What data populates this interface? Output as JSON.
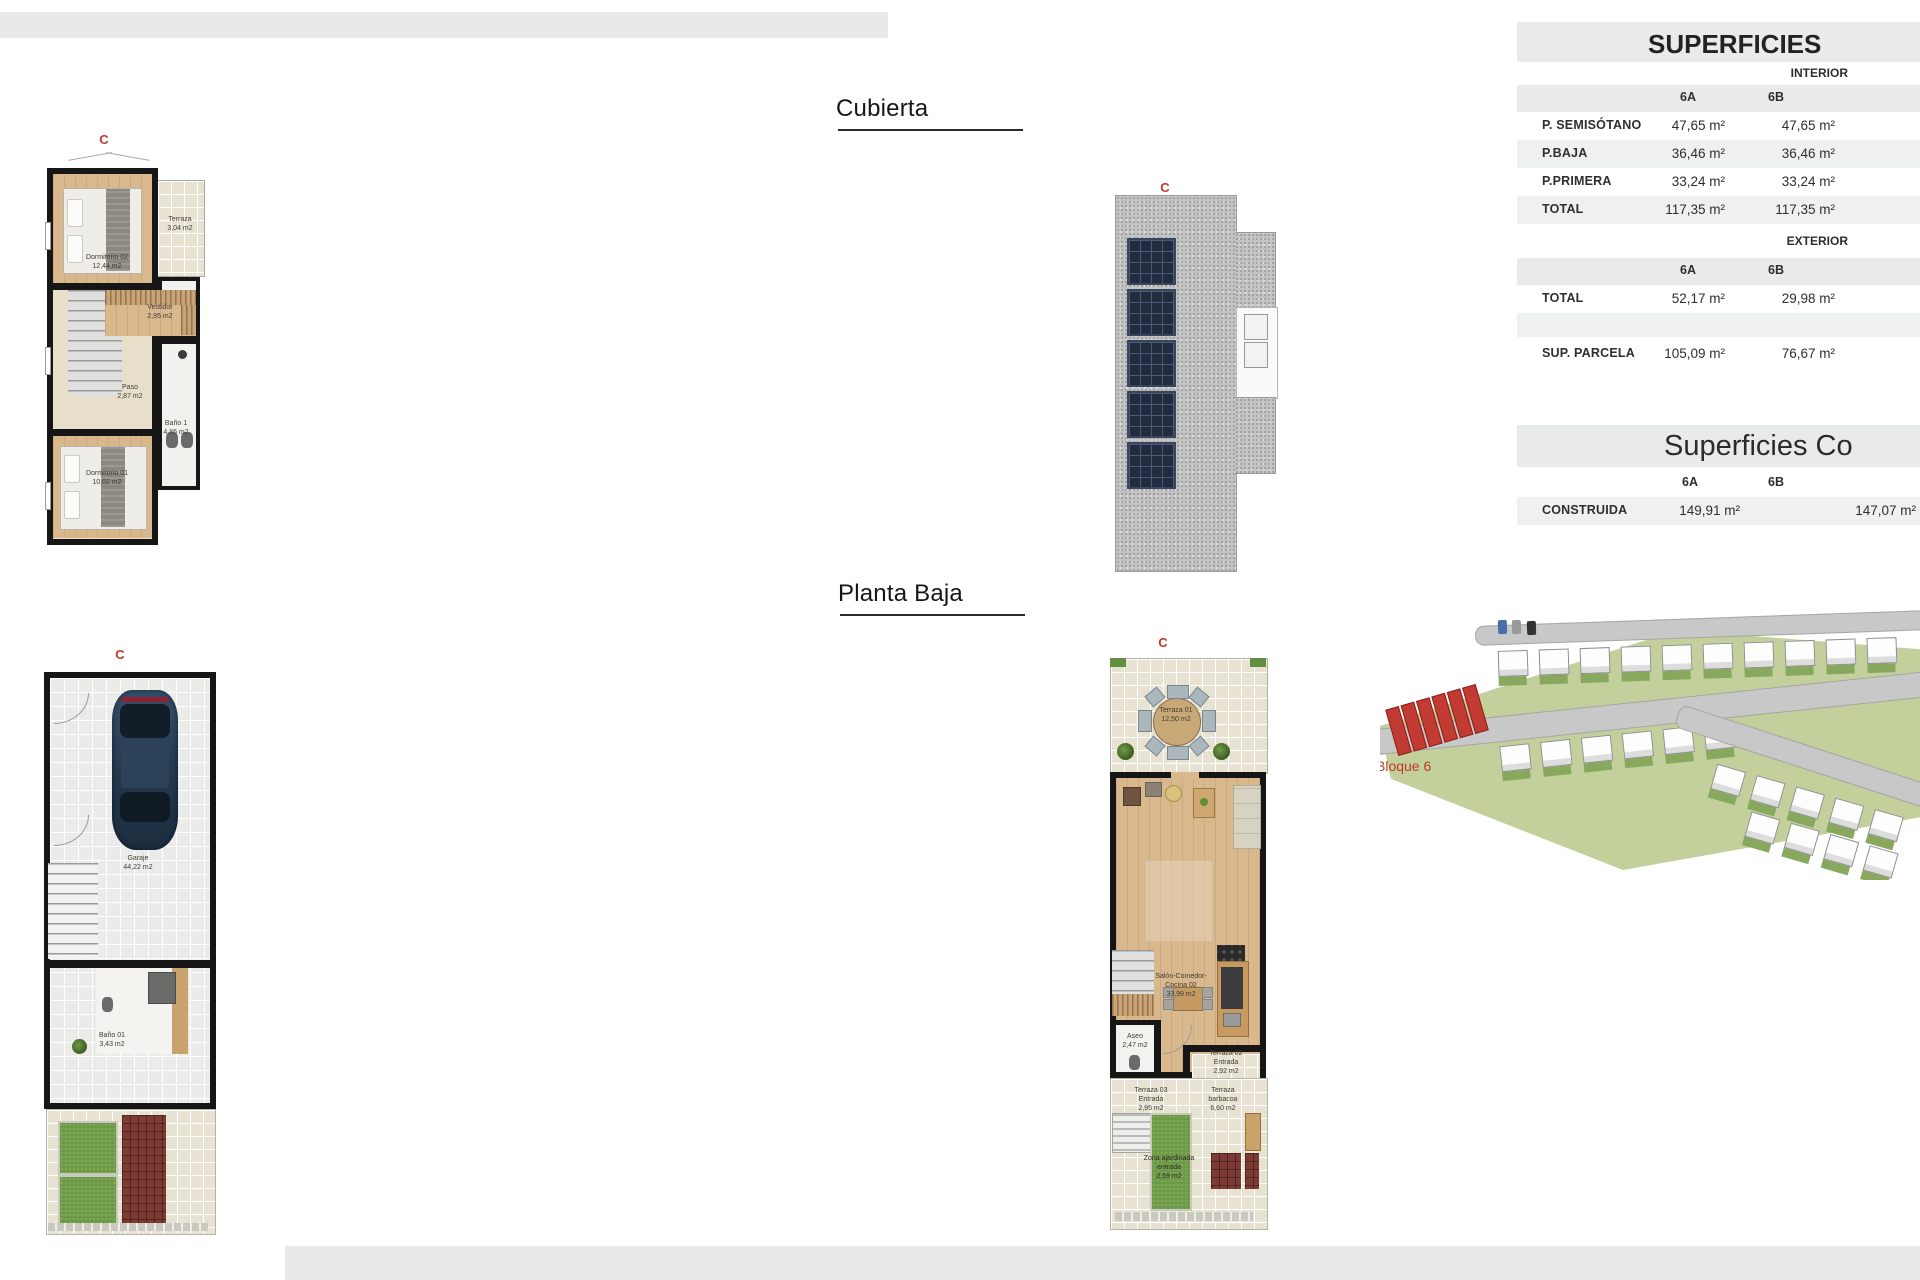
{
  "titles": {
    "cubierta": "Cubierta",
    "planta_baja": "Planta Baja"
  },
  "marker": "C",
  "superficies": {
    "title": "SUPERFICIES",
    "interior_label": "INTERIOR",
    "exterior_label": "EXTERIOR",
    "col_a": "6A",
    "col_b": "6B",
    "interior_rows": [
      {
        "label": "P. SEMISÓTANO",
        "a": "47,65 m²",
        "b": "47,65 m²"
      },
      {
        "label": "P.BAJA",
        "a": "36,46 m²",
        "b": "36,46 m²"
      },
      {
        "label": "P.PRIMERA",
        "a": "33,24 m²",
        "b": "33,24 m²"
      },
      {
        "label": "TOTAL",
        "a": "117,35 m²",
        "b": "117,35 m²"
      }
    ],
    "exterior_total": {
      "label": "TOTAL",
      "a": "52,17 m²",
      "b": "29,98 m²"
    },
    "parcela": {
      "label": "SUP. PARCELA",
      "a": "105,09 m²",
      "b": "76,67 m²"
    }
  },
  "construidas": {
    "title": "Superficies Co",
    "col_a": "6A",
    "col_b": "6B",
    "row": {
      "label": "CONSTRUIDA",
      "a": "149,91 m²",
      "b": "147,07 m²"
    }
  },
  "plan_primera": {
    "rooms": {
      "dormitorio02": "Dormitorio 02\n12,44 m2",
      "terraza": "Terraza\n3,04 m2",
      "vestidor": "Vestidor\n2,95 m2",
      "paso": "Paso\n2,87 m2",
      "bano1": "Baño 1\n4,86 m2",
      "dormitorio01": "Dormitorio 01\n10,02 m2"
    }
  },
  "plan_garaje": {
    "rooms": {
      "garaje": "Garaje\n44,22 m2",
      "bano01": "Baño 01\n3,43 m2"
    }
  },
  "plan_planta_baja": {
    "rooms": {
      "terraza01": "Terraza 01\n12,50 m2",
      "salon": "Salón-Comedor-\nCocina 02\n33,99 m2",
      "aseo": "Aseo\n2,47 m2",
      "terraza02": "Terraza 02\nEntrada\n2,92 m2",
      "terraza03": "Terraza 03\nEntrada\n2,95 m2",
      "barbacoa": "Terraza\nbarbacoa\n6,60 m2",
      "zona_ajardinada": "Zona ajardinada\nentrada\n2,59 m2"
    }
  },
  "site_plan": {
    "label": "Bloque 6"
  },
  "colors": {
    "accent_red": "#c0392b",
    "wall": "#161616",
    "wood_floor": "#d9b88e",
    "grass": "#6d9a45",
    "panel_navy": "#222c3e",
    "table_band": "#e9ebeb",
    "table_row_alt": "#eff1f1"
  }
}
